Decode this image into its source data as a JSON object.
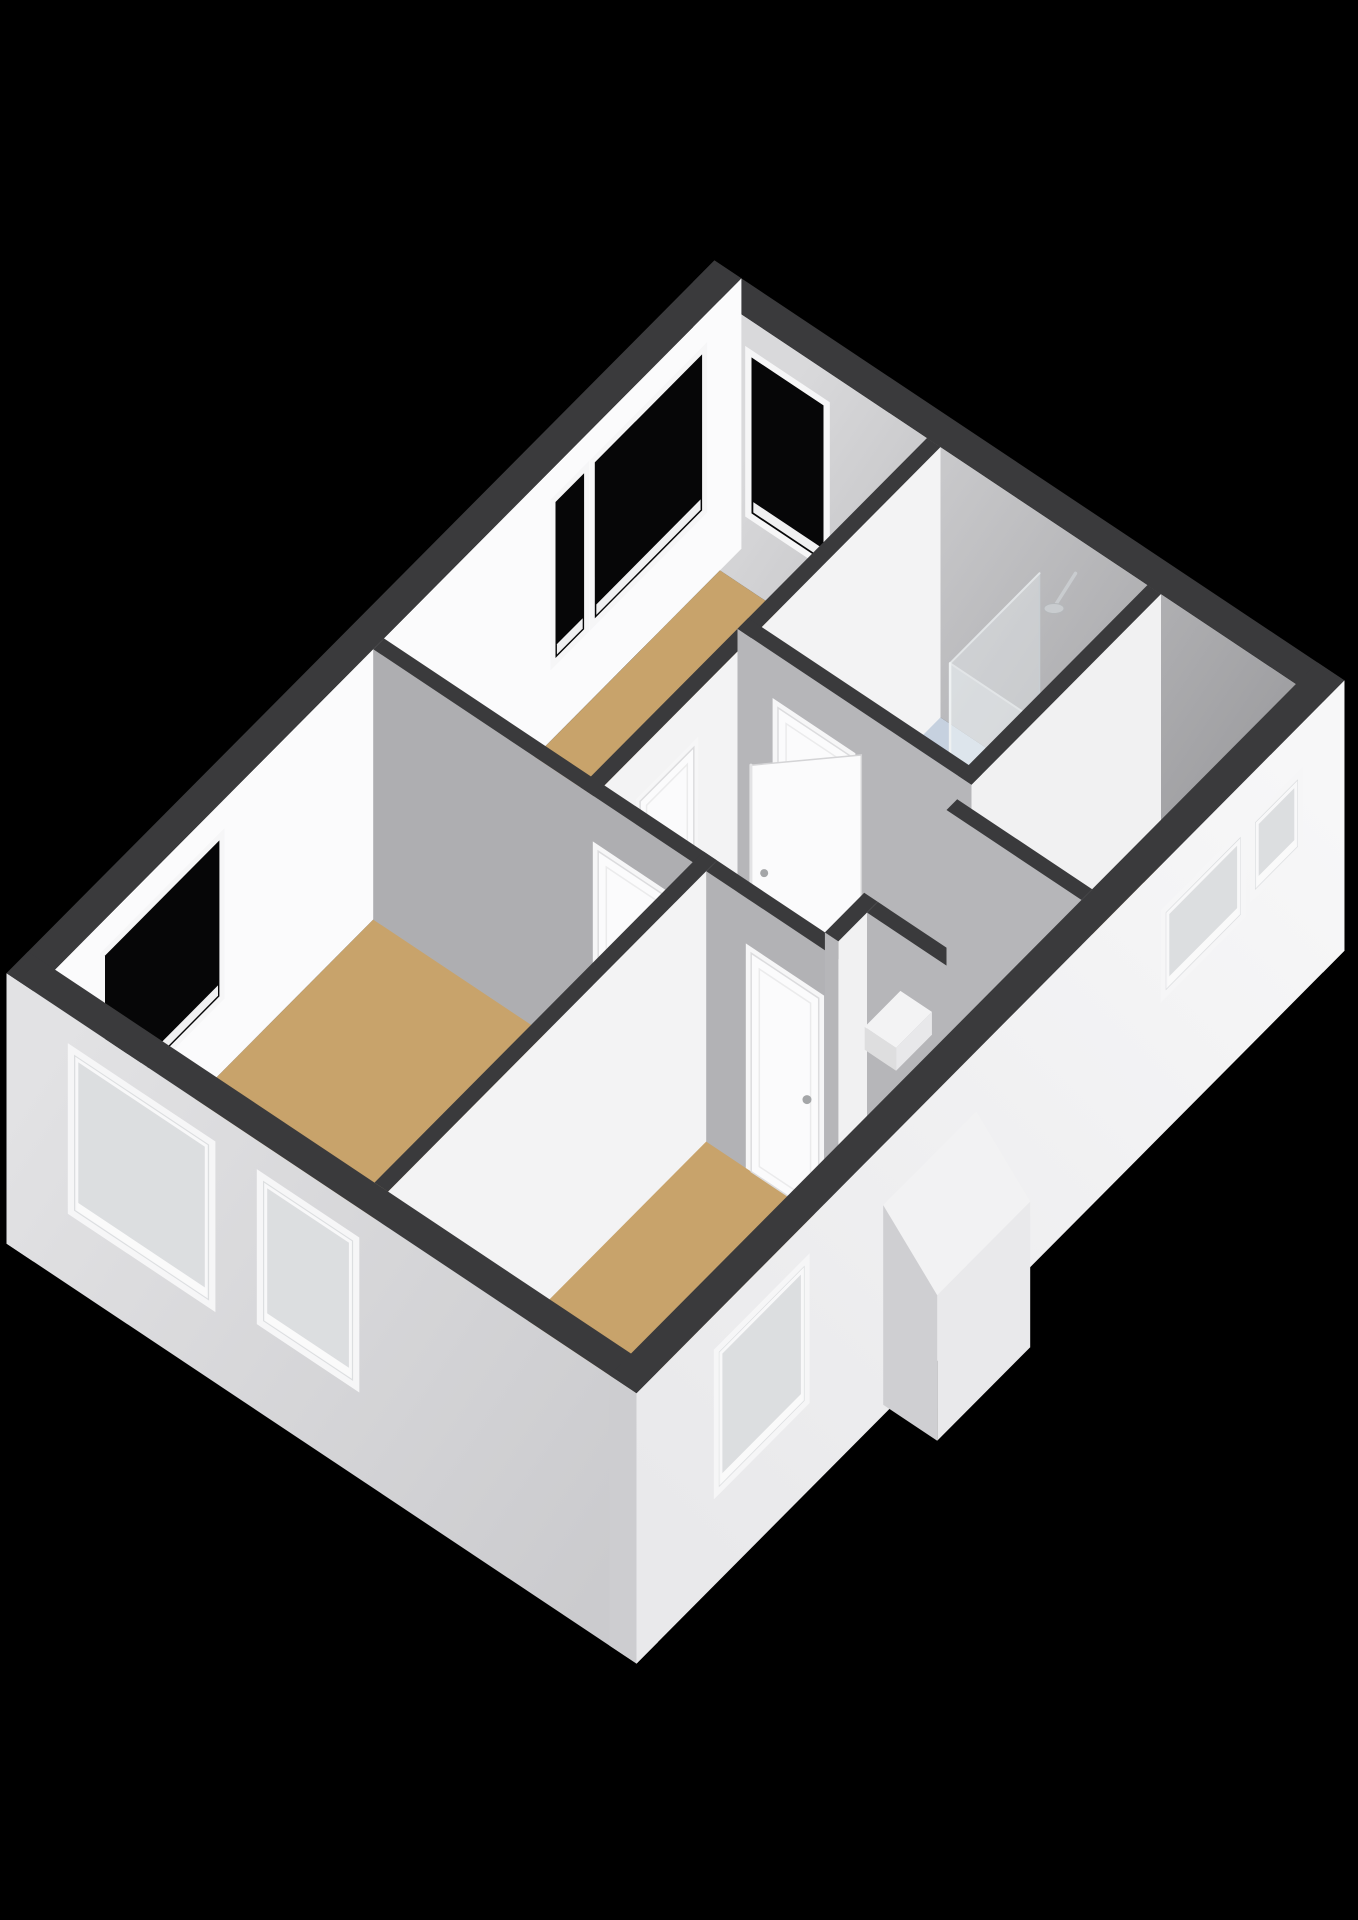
{
  "scene": {
    "canvas": [
      1358,
      1920
    ],
    "projection": {
      "origin": [
        55,
        1240
      ],
      "axisU": [
        71.5,
        -72
      ],
      "axisV": [
        90,
        60
      ],
      "vertical": 104,
      "wallHeight": 2.6
    },
    "colors": {
      "background": "#000000",
      "top": "#3a3a3c",
      "glassIn": "#060607",
      "glassOut": "#dcdee0",
      "casing": "#f6f6f7",
      "sill": "#f0f0f1",
      "leaf": "#fbfbfc",
      "leafStroke": "#dcdcde",
      "handle": "#a4a6a8",
      "floorTan": "#c8a36b",
      "floorBath": "#c6d1df",
      "void": "#6f7174",
      "tread": "#8d8f92",
      "oakFront": "#ccb197",
      "oakSide": "#bda186",
      "oakLine": "#b2977d",
      "counter": "#f5f6f7",
      "counterFront": "#ebecec",
      "basinFill": "#eef0f1",
      "basinStroke": "#d3d6d8",
      "showerGlass": "rgba(236,241,244,0.38)",
      "showerFrame": "#c8ced2",
      "chrome": "#c9cccf",
      "dormerTop": "#f2f2f3",
      "dormerFront": "#e9e9eb",
      "dormerSide": "#cfcfd2",
      "stepTop": "#f3f3f4",
      "stepWest": "#dededf",
      "stepSouth": "#e8e8ea"
    },
    "gradients": [
      {
        "id": "gradNE",
        "from": [
          9.3,
          0.3,
          1.3
        ],
        "to": [
          9.3,
          6.5,
          1.3
        ],
        "stops": [
          "#d9d9db",
          "#97979a"
        ]
      },
      {
        "id": "gradSW",
        "from": [
          -0.3,
          -0.3,
          1.3
        ],
        "to": [
          -0.3,
          6.7,
          1.3
        ],
        "stops": [
          "#e2e2e4",
          "#cbcbce"
        ]
      },
      {
        "id": "gradSE",
        "from": [
          0,
          6.7,
          1.3
        ],
        "to": [
          9.6,
          6.7,
          1.3
        ],
        "stops": [
          "#e9e9eb",
          "#f7f7f8"
        ]
      }
    ],
    "elements": [
      {
        "k": "floor",
        "name": "floor-bedroom-north",
        "u": [
          4.45,
          9.3
        ],
        "v": [
          0,
          2.3
        ],
        "c": "floorTan"
      },
      {
        "k": "floor",
        "name": "floor-bathroom",
        "u": [
          6.65,
          9.3
        ],
        "v": [
          2.3,
          4.9
        ],
        "c": "floorBath"
      },
      {
        "k": "floor",
        "name": "floor-bedroom-large",
        "u": [
          0,
          4.6
        ],
        "v": [
          0,
          3.7
        ],
        "c": "floorTan"
      },
      {
        "k": "floor",
        "name": "floor-landing",
        "u": [
          4.45,
          6.8
        ],
        "v": [
          2.3,
          4.9
        ],
        "c": "floorTan"
      },
      {
        "k": "floor",
        "name": "floor-landing-extension",
        "u": [
          6.65,
          9.3
        ],
        "v": [
          4.75,
          6.4
        ],
        "c": "floorTan"
      },
      {
        "k": "floor",
        "name": "floor-stair-corridor",
        "u": [
          4.45,
          6.65
        ],
        "v": [
          4.9,
          6.4
        ],
        "c": "floorTan"
      },
      {
        "k": "floor",
        "name": "floor-bedroom-bottom",
        "u": [
          0,
          4.6
        ],
        "v": [
          3.55,
          6.4
        ],
        "c": "floorTan"
      },
      {
        "k": "void",
        "name": "stairwell-opening",
        "u": [
          5.15,
          6.3
        ],
        "v": [
          5.05,
          6.4
        ],
        "c": "void",
        "treads": [
          5.3,
          5.55,
          5.8,
          6.05,
          6.3
        ]
      },
      {
        "k": "wall",
        "name": "wall-exterior-ne",
        "u": [
          9.3,
          9.6
        ],
        "v": [
          -0.3,
          6.7
        ],
        "west": "gradNE",
        "south": "#f1f1f2",
        "windows": [
          {
            "face": "west",
            "a": [
              0.35,
              1.15
            ],
            "z": [
              0.75,
              2.25
            ],
            "style": "in"
          }
        ]
      },
      {
        "k": "wall",
        "name": "wall-exterior-nw",
        "u": [
          -0.3,
          9.6
        ],
        "v": [
          -0.3,
          0
        ],
        "west": "#dfdfe1",
        "south": "#fbfbfc",
        "windows": [
          {
            "face": "south",
            "a": [
              0.7,
              2.3
            ],
            "z": [
              0.75,
              2.25
            ],
            "style": "in"
          },
          {
            "face": "south",
            "a": [
              7.0,
              7.4
            ],
            "z": [
              0.75,
              2.25
            ],
            "style": "in"
          },
          {
            "face": "south",
            "a": [
              7.55,
              9.05
            ],
            "z": [
              0.75,
              2.25
            ],
            "style": "in"
          }
        ]
      },
      {
        "k": "wall",
        "name": "wall-bedroom-north-south",
        "u": [
          4.45,
          9.3
        ],
        "v": [
          2.3,
          2.45
        ],
        "south": "#f3f3f4",
        "doors": [
          {
            "face": "south",
            "a": [
              5.1,
              5.85
            ]
          }
        ]
      },
      {
        "k": "vanity",
        "name": "bathroom-vanity",
        "u": [
          7.0,
          8.2
        ],
        "v": [
          2.45,
          2.98
        ]
      },
      {
        "k": "shower",
        "name": "shower-enclosure",
        "corner": [
          8.05,
          3.55
        ],
        "ext": [
          9.3,
          4.75
        ],
        "headV": 3.95
      },
      {
        "k": "wall",
        "name": "wall-bathroom-west",
        "u": [
          6.65,
          6.8
        ],
        "v": [
          2.3,
          4.9
        ],
        "west": "#b6b6b9",
        "south": "#f1f1f2",
        "doors": [
          {
            "face": "west",
            "a": [
              2.75,
              3.55
            ]
          }
        ]
      },
      {
        "k": "wall",
        "name": "wall-bathroom-south",
        "u": [
          6.65,
          9.3
        ],
        "v": [
          4.75,
          4.9
        ],
        "west": "#b6b6b9",
        "south": "#f1f1f2"
      },
      {
        "k": "opendoor",
        "name": "open-door-bathroom",
        "hinge": [
          6.72,
          3.62
        ],
        "end": [
          6.02,
          2.95
        ]
      },
      {
        "k": "wall",
        "name": "wall-bedroom-large-east",
        "u": [
          4.45,
          4.6
        ],
        "v": [
          0,
          3.7
        ],
        "west": "#aeaeb1",
        "south": "#f1f1f2",
        "doors": [
          {
            "face": "west",
            "a": [
              2.5,
              3.3
            ]
          }
        ]
      },
      {
        "k": "wall",
        "name": "wall-bedrooms-divider",
        "u": [
          0,
          4.6
        ],
        "v": [
          3.55,
          3.7
        ],
        "west": "#b6b6b9",
        "south": "#f3f3f4"
      },
      {
        "k": "wall",
        "name": "wall-stair-west",
        "u": [
          4.45,
          4.6
        ],
        "v": [
          3.7,
          6.4
        ],
        "west": "#b2b2b5",
        "south": "#f1f1f2",
        "doors": [
          {
            "face": "west",
            "a": [
              4.2,
              4.95
            ]
          }
        ]
      },
      {
        "k": "wall",
        "name": "wall-stair-jog-a",
        "u": [
          4.6,
          5.15
        ],
        "v": [
          4.9,
          5.05
        ],
        "west": "#b6b6b9",
        "south": "#f1f1f2"
      },
      {
        "k": "wall",
        "name": "wall-stair-jog-b",
        "u": [
          5.0,
          5.15
        ],
        "v": [
          5.05,
          6.4
        ],
        "west": "#b6b6b9",
        "south": "#f1f1f2"
      },
      {
        "k": "wall",
        "name": "wall-stair-east",
        "u": [
          6.3,
          6.45
        ],
        "v": [
          4.9,
          6.4
        ],
        "west": "#b6b6b9",
        "south": "#f1f1f2"
      },
      {
        "k": "step",
        "name": "stair-top-step",
        "u": [
          6.1,
          6.6
        ],
        "v": [
          4.15,
          4.5
        ],
        "h": 0.22
      },
      {
        "k": "wall",
        "name": "wall-exterior-sw",
        "u": [
          -0.3,
          0
        ],
        "v": [
          -0.3,
          6.7
        ],
        "west": "gradSW",
        "south": "#f1f1f2",
        "windows": [
          {
            "face": "west",
            "a": [
              0.45,
              1.95
            ],
            "z": [
              0.75,
              2.25
            ],
            "style": "out"
          },
          {
            "face": "west",
            "a": [
              2.55,
              3.55
            ],
            "z": [
              0.9,
              2.25
            ],
            "style": "out"
          }
        ]
      },
      {
        "k": "wall",
        "name": "wall-exterior-se",
        "u": [
          -0.3,
          9.6
        ],
        "v": [
          6.4,
          6.7
        ],
        "west": "#cdcdd0",
        "south": "gradSE",
        "windows": [
          {
            "face": "south",
            "a": [
              0.85,
              2.05
            ],
            "z": [
              0.9,
              2.2
            ],
            "style": "out"
          },
          {
            "face": "south",
            "a": [
              7.1,
              8.15
            ],
            "z": [
              1.35,
              2.1
            ],
            "style": "out"
          },
          {
            "face": "south",
            "a": [
              8.35,
              8.95
            ],
            "z": [
              1.45,
              2.1
            ],
            "style": "out"
          }
        ]
      },
      {
        "k": "dormer",
        "name": "se-facade-dormer-notch",
        "u": [
          3.15,
          4.45
        ]
      }
    ]
  }
}
